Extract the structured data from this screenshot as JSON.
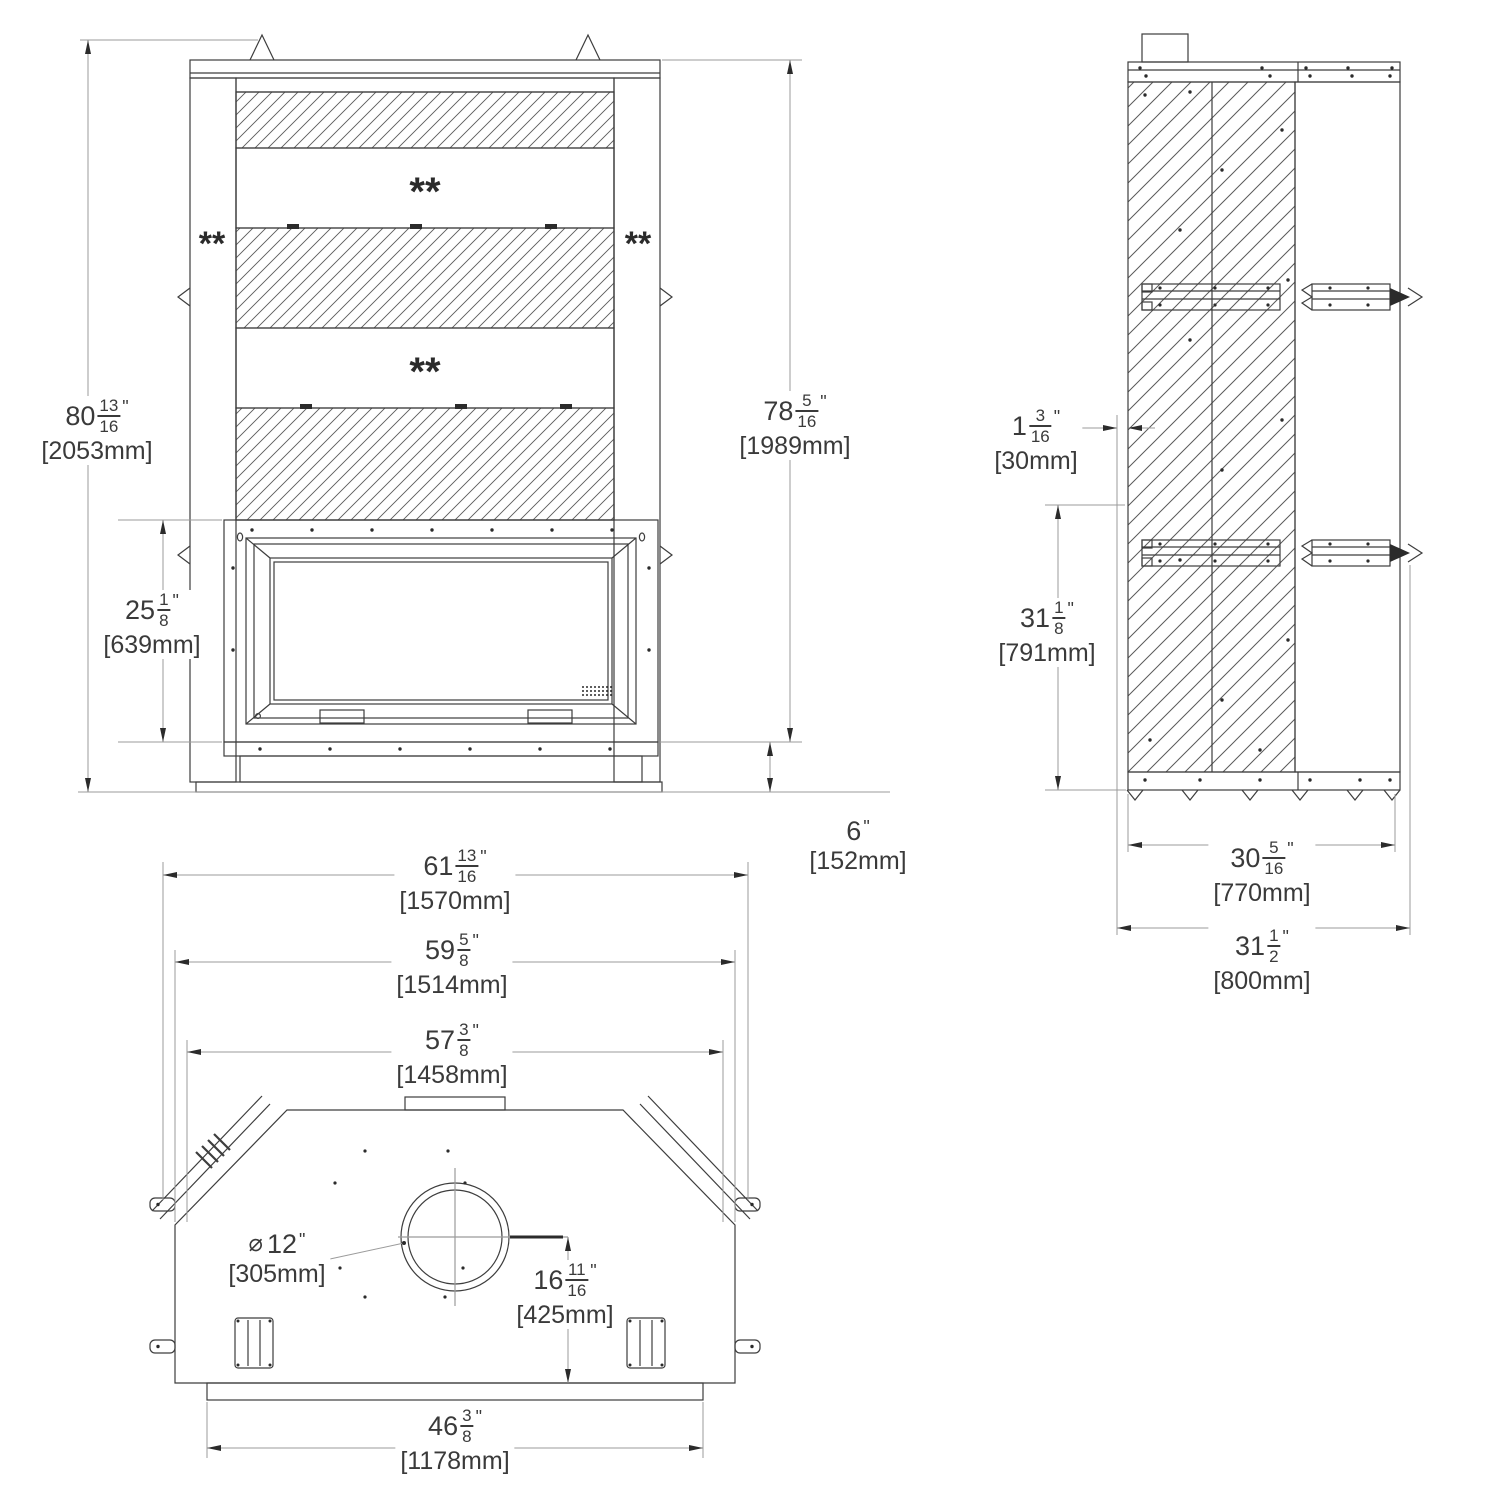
{
  "drawing": {
    "description": "Three-view dimensioned technical drawing of a wood fireplace unit: front view, side view and bottom view",
    "line_color": "#3d3d3d",
    "dim_line_color": "#9b9b9b",
    "text_color": "#3a3a3a",
    "background": "#ffffff"
  },
  "marks": {
    "front_band1": "**",
    "front_band2": "**",
    "front_left_column": "**",
    "front_right_column": "**"
  },
  "dims": {
    "front_total_height": {
      "whole": "80",
      "num": "13",
      "den": "16",
      "unit": "\"",
      "mm": "[2053mm]"
    },
    "front_right_height": {
      "whole": "78",
      "num": "5",
      "den": "16",
      "unit": "\"",
      "mm": "[1989mm]"
    },
    "front_firebox_height": {
      "whole": "25",
      "num": "1",
      "den": "8",
      "unit": "\"",
      "mm": "[639mm]"
    },
    "front_hearth_height": {
      "whole": "6",
      "unit": "\"",
      "mm": "[152mm]"
    },
    "bottom_width_total": {
      "whole": "61",
      "num": "13",
      "den": "16",
      "unit": "\"",
      "mm": "[1570mm]"
    },
    "bottom_width_mid": {
      "whole": "59",
      "num": "5",
      "den": "8",
      "unit": "\"",
      "mm": "[1514mm]"
    },
    "bottom_width_face": {
      "whole": "57",
      "num": "3",
      "den": "8",
      "unit": "\"",
      "mm": "[1458mm]"
    },
    "bottom_width_base": {
      "whole": "46",
      "num": "3",
      "den": "8",
      "unit": "\"",
      "mm": "[1178mm]"
    },
    "bottom_flue_offset": {
      "whole": "16",
      "num": "11",
      "den": "16",
      "unit": "\"",
      "mm": "[425mm]"
    },
    "bottom_flue_diameter": {
      "pre": "⌀",
      "whole": "12",
      "unit": "\"",
      "mm": "[305mm]"
    },
    "side_top_offset": {
      "whole": "1",
      "num": "3",
      "den": "16",
      "unit": "\"",
      "mm": "[30mm]"
    },
    "side_lower_height": {
      "whole": "31",
      "num": "1",
      "den": "8",
      "unit": "\"",
      "mm": "[791mm]"
    },
    "side_depth_inner": {
      "whole": "30",
      "num": "5",
      "den": "16",
      "unit": "\"",
      "mm": "[770mm]"
    },
    "side_depth_total": {
      "whole": "31",
      "num": "1",
      "den": "2",
      "unit": "\"",
      "mm": "[800mm]"
    }
  }
}
